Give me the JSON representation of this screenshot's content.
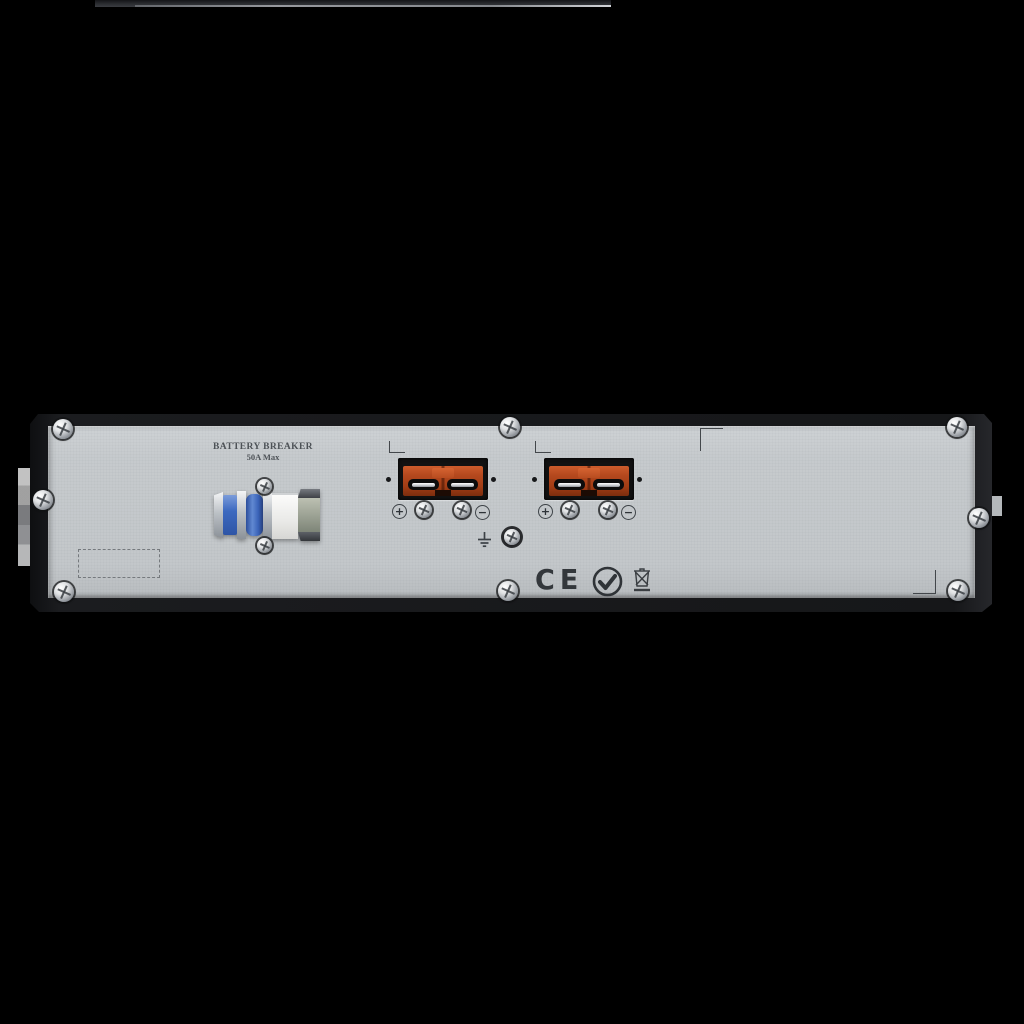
{
  "scene": {
    "type": "product-photo",
    "subject": "Rack-mount UPS external battery pack - rear panel (2U)",
    "background": "#000000"
  },
  "labels": {
    "breaker_title": "BATTERY BREAKER",
    "breaker_rating": "50A Max"
  },
  "symbols": {
    "plus": "+",
    "minus": "−",
    "ce": "CE"
  },
  "icons": {
    "screw": "phillips-screw-icon",
    "ground": "earth-ground-icon",
    "rcm": "rcm-certification-icon",
    "weee": "weee-crossed-bin-icon",
    "breaker": "circuit-breaker-switch",
    "connector": "anderson-battery-connector"
  },
  "colors": {
    "background": "#000000",
    "panel_gray": "#c6cacd",
    "frame_black": "#1a1b1d",
    "connector_orange": "#b5491e",
    "breaker_blue": "#3c69c0"
  },
  "connectors": [
    {
      "name": "battery-connector-1",
      "polarity_left": "+",
      "polarity_right": "−"
    },
    {
      "name": "battery-connector-2",
      "polarity_left": "+",
      "polarity_right": "−"
    }
  ]
}
